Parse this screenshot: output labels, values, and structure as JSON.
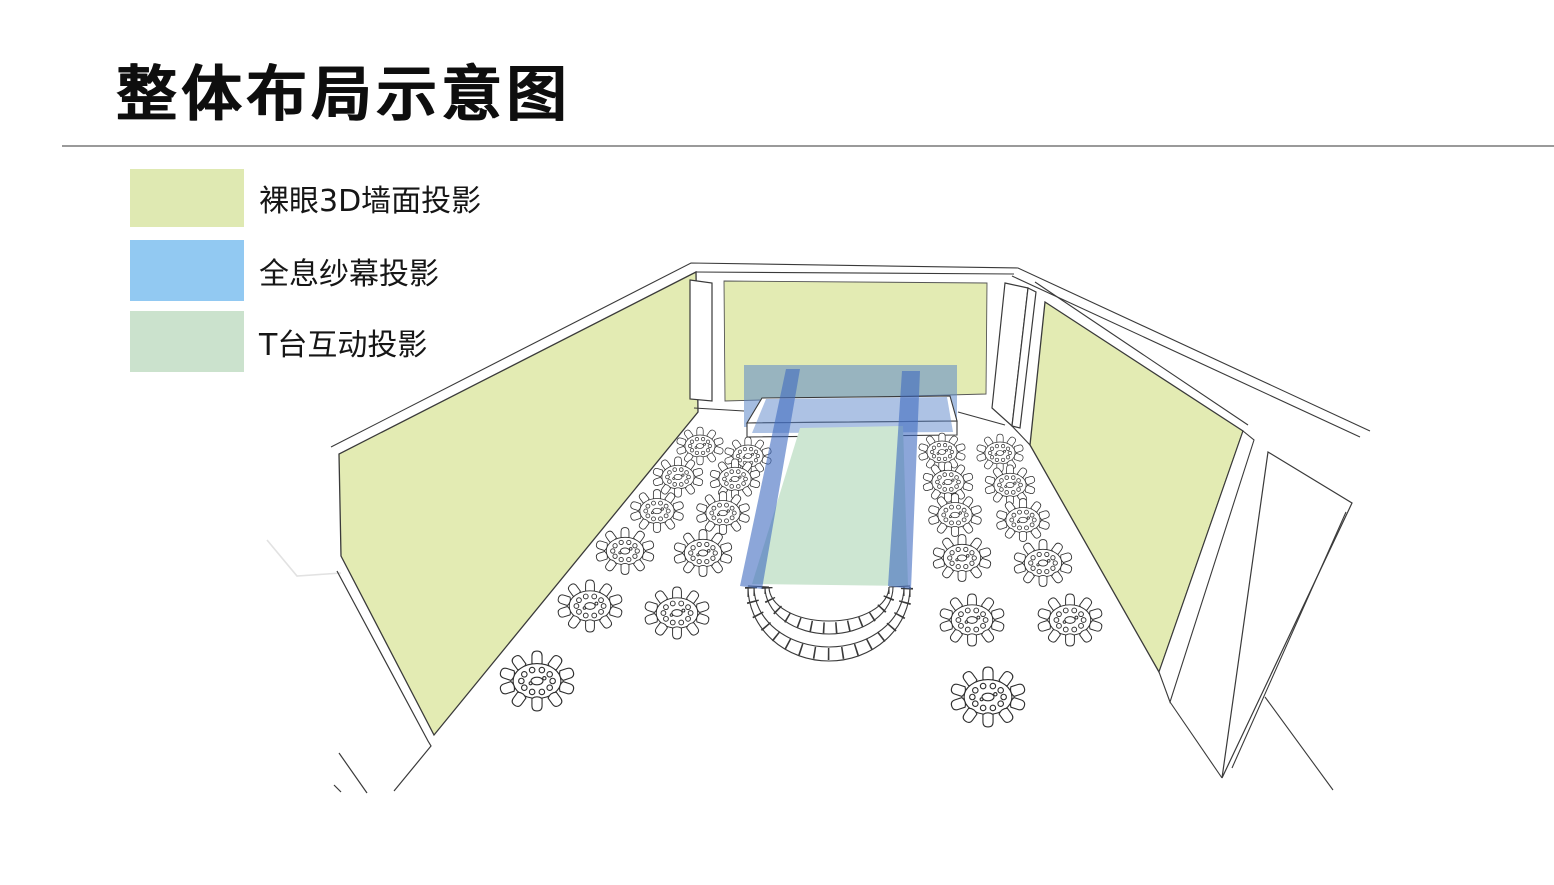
{
  "title": "整体布局示意图",
  "legend": {
    "items": [
      {
        "label": "裸眼3D墙面投影",
        "color": "#dfe9b2"
      },
      {
        "label": "全息纱幕投影",
        "color": "#92c9f2"
      },
      {
        "label": "T台互动投影",
        "color": "#cbe2cd"
      }
    ]
  },
  "diagram": {
    "colors": {
      "wall": "#e3ebb3",
      "screen": "rgba(91,134,201,0.55)",
      "stage_overlay": "rgba(91,134,201,0.5)",
      "beam": "rgba(64,106,192,0.6)",
      "runway": "#cde6d2",
      "outline": "#3a3a3a"
    },
    "tables": [
      {
        "x": 700,
        "y": 446,
        "s": 0.58
      },
      {
        "x": 748,
        "y": 456,
        "s": 0.58
      },
      {
        "x": 678,
        "y": 477,
        "s": 0.62
      },
      {
        "x": 735,
        "y": 479,
        "s": 0.62
      },
      {
        "x": 657,
        "y": 511,
        "s": 0.66
      },
      {
        "x": 723,
        "y": 513,
        "s": 0.66
      },
      {
        "x": 625,
        "y": 551,
        "s": 0.72
      },
      {
        "x": 703,
        "y": 553,
        "s": 0.72
      },
      {
        "x": 590,
        "y": 606,
        "s": 0.8
      },
      {
        "x": 677,
        "y": 613,
        "s": 0.8
      },
      {
        "x": 537,
        "y": 681,
        "s": 0.92
      },
      {
        "x": 942,
        "y": 452,
        "s": 0.58
      },
      {
        "x": 1000,
        "y": 453,
        "s": 0.58
      },
      {
        "x": 948,
        "y": 482,
        "s": 0.62
      },
      {
        "x": 1010,
        "y": 485,
        "s": 0.62
      },
      {
        "x": 955,
        "y": 515,
        "s": 0.66
      },
      {
        "x": 1023,
        "y": 520,
        "s": 0.66
      },
      {
        "x": 962,
        "y": 558,
        "s": 0.72
      },
      {
        "x": 1043,
        "y": 563,
        "s": 0.72
      },
      {
        "x": 972,
        "y": 620,
        "s": 0.8
      },
      {
        "x": 1070,
        "y": 620,
        "s": 0.8
      },
      {
        "x": 988,
        "y": 697,
        "s": 0.92
      }
    ]
  }
}
